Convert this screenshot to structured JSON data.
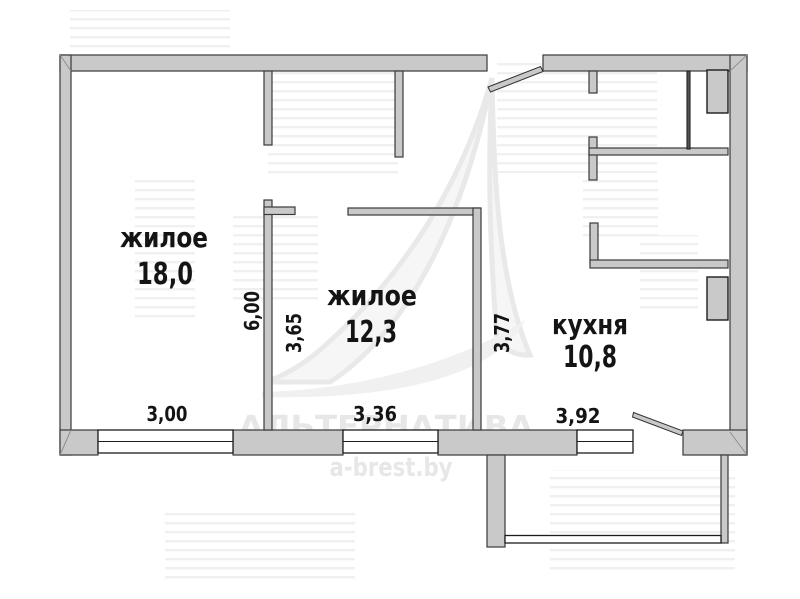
{
  "plan": {
    "rooms": [
      {
        "label": "жилое",
        "area": "18,0"
      },
      {
        "label": "жилое",
        "area": "12,3"
      },
      {
        "label": "кухня",
        "area": "10,8"
      }
    ],
    "dimensions": {
      "horizontal": [
        "3,00",
        "3,36",
        "3,92"
      ],
      "vertical": [
        "6,00",
        "3,65",
        "3,77"
      ]
    },
    "watermark": {
      "brand": "АЛЬТЕРНАТИВА",
      "site": "a-brest.by"
    },
    "colors": {
      "wall_fill": "#c9c9c9",
      "wall_outline": "#3a3a3a",
      "text": "#141414",
      "watermark_text": "#e7e7e7"
    }
  }
}
